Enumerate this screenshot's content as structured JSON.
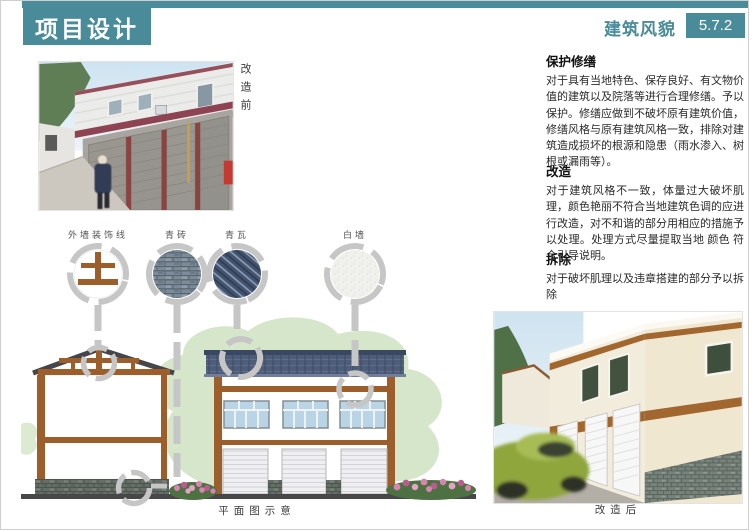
{
  "header": {
    "title": "项目设计",
    "section_label": "建筑风貌",
    "section_number": "5.7.2",
    "accent_color": "#4A8B99"
  },
  "before_photo": {
    "caption": "改造前"
  },
  "after_photo": {
    "caption": "改造后"
  },
  "materials": [
    {
      "label": "外墙装饰线",
      "swatch": "decorative-line-swatch"
    },
    {
      "label": "青砖",
      "swatch": "grey-brick-swatch"
    },
    {
      "label": "青瓦",
      "swatch": "grey-tile-swatch"
    },
    {
      "label": "白墙",
      "swatch": "white-wall-swatch"
    }
  ],
  "elevation": {
    "caption": "平面图示意"
  },
  "guidelines": [
    {
      "heading": "保护修缮",
      "body": "对于具有当地特色、保存良好、有文物价值的建筑以及院落等进行合理修缮。予以保护。修缮应做到不破坏原有建筑价值，修缮风格与原有建筑风格一致，排除对建筑造成损坏的根源和隐患（雨水渗入、树根或漏雨等）。"
    },
    {
      "heading": "改造",
      "body": "对于建筑风格不一致，体量过大破坏肌理，颜色艳丽不符合当地建筑色调的应进行改造，对不和谐的部分用相应的措施予以处理。处理方式尽量提取当地 颜色 符合引导说明。"
    },
    {
      "heading": "拆除",
      "body": "对于破坏肌理以及违章搭建的部分予以拆除"
    }
  ],
  "colors": {
    "accent_teal": "#4A8B99",
    "connector_gray": "#c6c6c6",
    "timber_brown": "#9c5f2b",
    "roof_slate": "#4e5d7a",
    "tree_green": "#d5e6ca"
  }
}
